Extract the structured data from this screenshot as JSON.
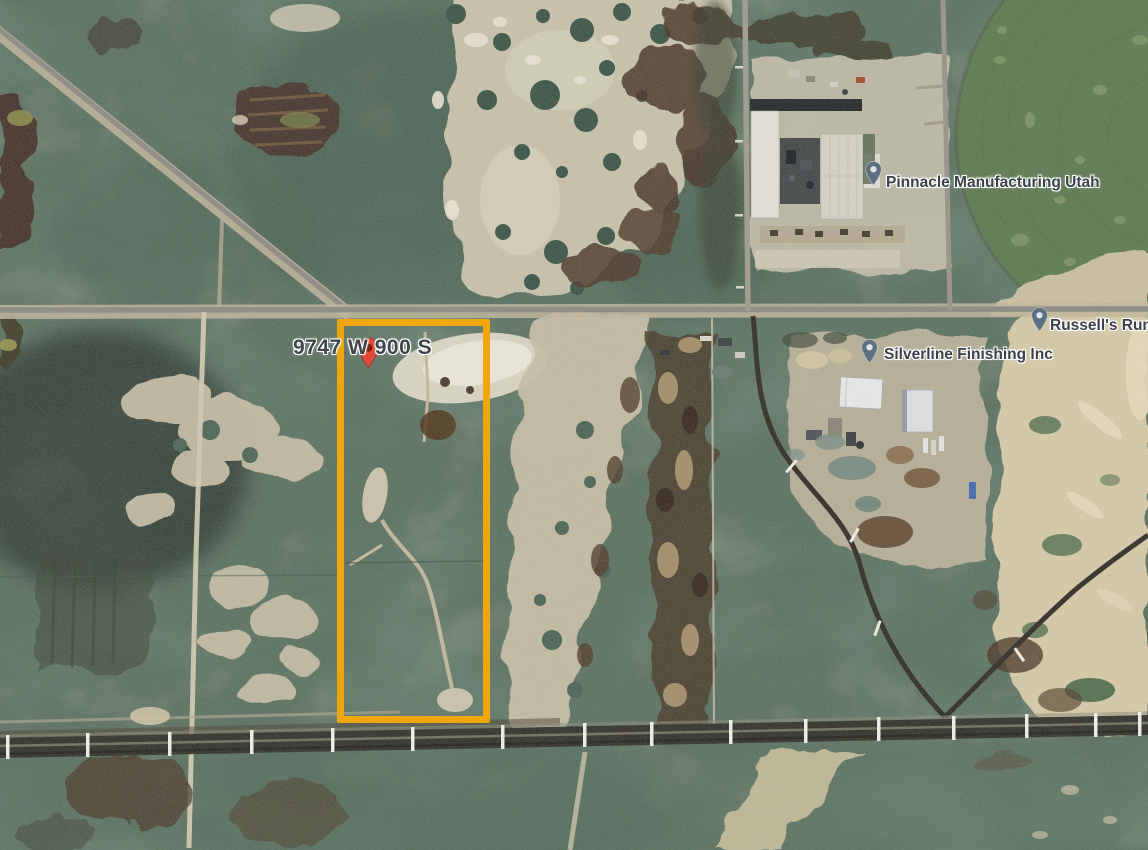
{
  "map": {
    "view": "satellite",
    "address_label": {
      "text": "9747 W 900 S"
    },
    "places": [
      {
        "name": "Pinnacle Manufacturing Utah"
      },
      {
        "name": "Silverline Finishing Inc"
      },
      {
        "name": "Russell's Run"
      }
    ],
    "annotation": {
      "shape": "rectangle",
      "style": "border-color:#f1a60b",
      "color": "#f1a60b"
    },
    "pin_colors": {
      "address_body": "#df4b38",
      "address_dot": "#7e1a10",
      "place_body": "#5d6f80",
      "place_dot": "#dde3e8"
    }
  }
}
